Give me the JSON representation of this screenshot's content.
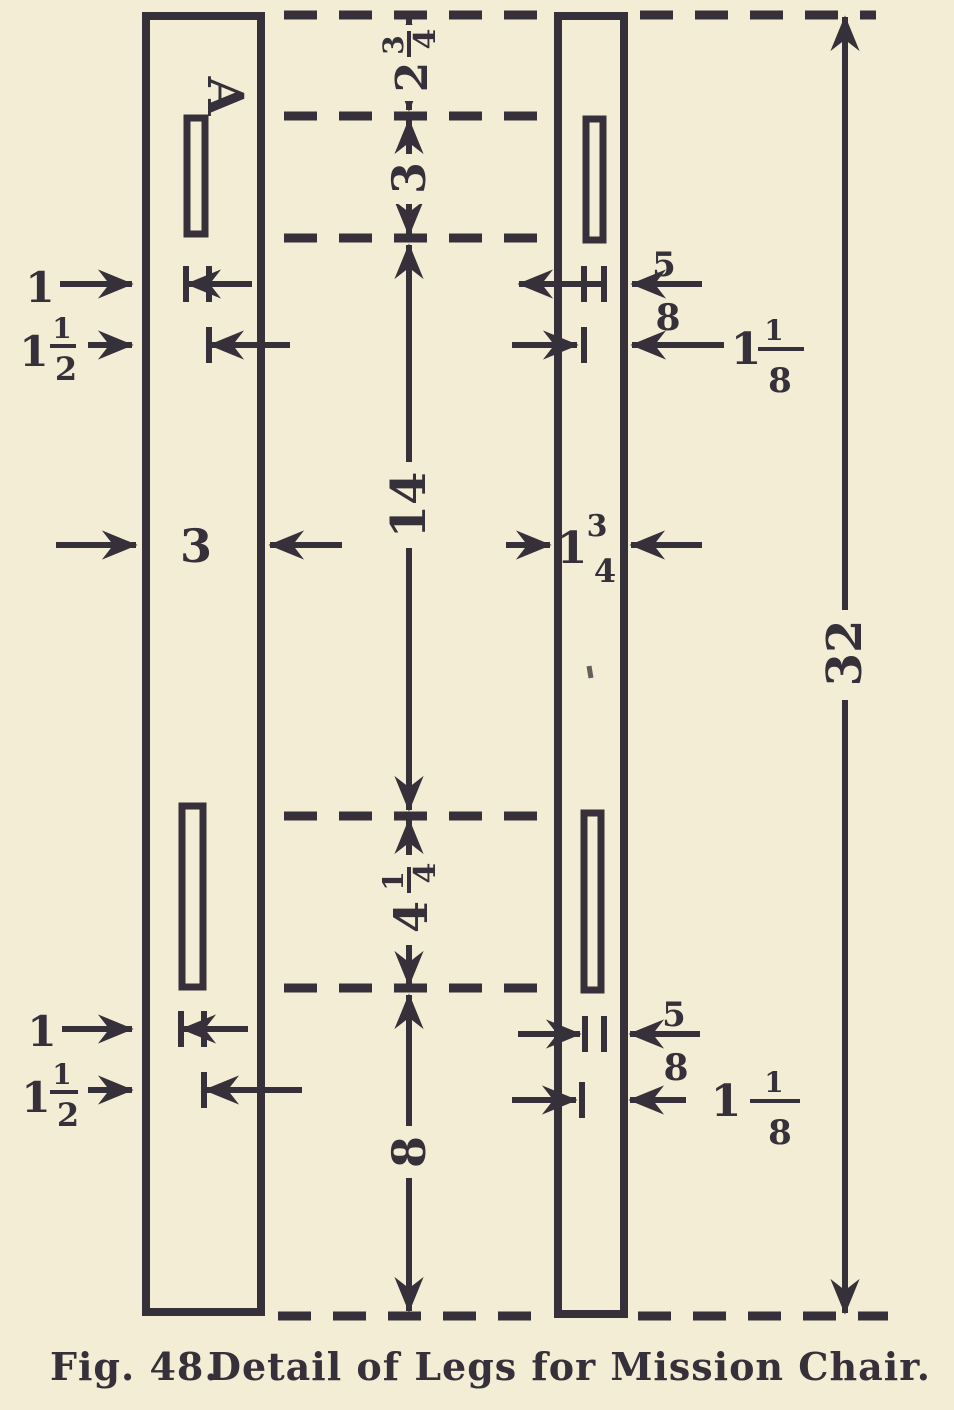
{
  "colors": {
    "paper": "#f2edd4",
    "ink": "#35303a"
  },
  "annotation": {
    "part_label": "A"
  },
  "dims": {
    "top_offset": {
      "whole": "2",
      "num": "3",
      "den": "4"
    },
    "top_slot_length": {
      "whole": "3"
    },
    "center_span": {
      "whole": "14"
    },
    "left_leg_width": {
      "whole": "3"
    },
    "right_leg_width": {
      "whole": "1",
      "num": "3",
      "den": "4"
    },
    "overall_length": {
      "whole": "32"
    },
    "lower_slot_length": {
      "whole": "4",
      "num": "1",
      "den": "4"
    },
    "bottom_offset": {
      "whole": "8"
    },
    "left_top_edge": {
      "whole": "1"
    },
    "left_top_inset": {
      "whole": "1",
      "num": "1",
      "den": "2"
    },
    "right_top_small": {
      "num": "5",
      "den": "8"
    },
    "right_top_inset": {
      "whole": "1",
      "num": "1",
      "den": "8"
    },
    "left_bottom_edge": {
      "whole": "1"
    },
    "left_bottom_inset": {
      "whole": "1",
      "num": "1",
      "den": "2"
    },
    "right_bottom_small": {
      "num": "5",
      "den": "8"
    },
    "right_bottom_inset": {
      "whole": "1",
      "num": "1",
      "den": "8"
    }
  },
  "caption": {
    "figure": "Fig. 48.",
    "title": "Detail of Legs for Mission Chair."
  }
}
